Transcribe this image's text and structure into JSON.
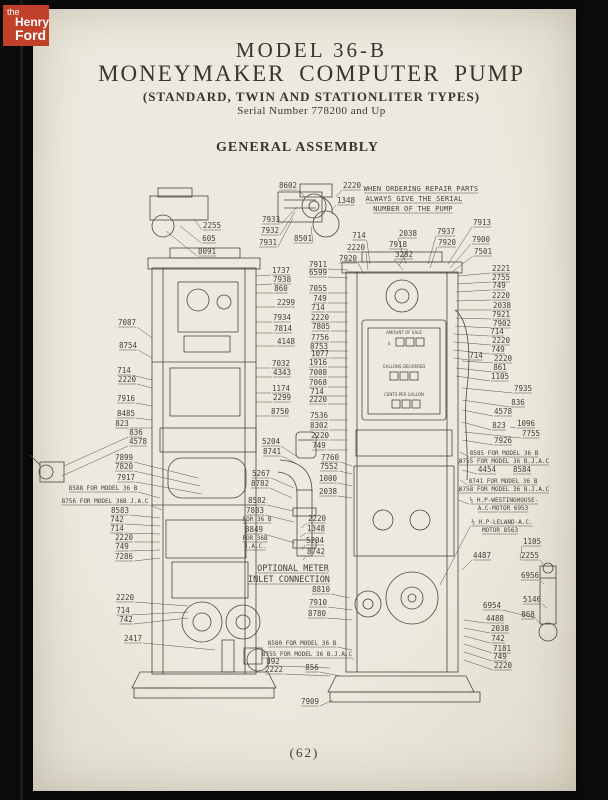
{
  "logo": {
    "the": "the",
    "henry": "Henry",
    "ford": "Ford"
  },
  "header": {
    "title_line1": "MODEL 36-B",
    "title_line2": "MONEYMAKER COMPUTER PUMP",
    "subtitle": "(STANDARD, TWIN AND STATIONLITER TYPES)",
    "serial": "Serial Number 778200 and Up",
    "section": "GENERAL ASSEMBLY"
  },
  "footer": {
    "page_number": "(62)"
  },
  "colors": {
    "page": "#e8e5d9",
    "ink": "#38352c",
    "line": "#4b473c",
    "logo_red": "#c0402a",
    "backdrop": "#0b0b0b"
  },
  "diagram": {
    "ordering_note": "WHEN ORDERING REPAIR PARTS ALWAYS GIVE THE SERIAL NUMBER OF THE PUMP",
    "face_lines": [
      [
        "AMOUNT OF SALE",
        404,
        334
      ],
      [
        "$",
        389,
        345
      ],
      [
        "GALLONS DELIVERED",
        404,
        368
      ],
      [
        "CENTS PER GALLON",
        404,
        396
      ]
    ],
    "labels": [
      [
        "WHEN ORDERING REPAIR PARTS",
        421,
        191,
        null,
        null,
        2
      ],
      [
        "ALWAYS GIVE THE SERIAL",
        414,
        201,
        null,
        null,
        2
      ],
      [
        "NUMBER OF THE PUMP",
        413,
        211,
        null,
        null,
        2
      ],
      [
        "8602",
        288,
        188,
        305,
        197
      ],
      [
        "2220",
        352,
        188,
        336,
        197
      ],
      [
        "1348",
        346,
        203,
        331,
        211
      ],
      [
        "2255",
        212,
        228,
        194,
        219
      ],
      [
        "605",
        209,
        241,
        180,
        226
      ],
      [
        "8091",
        207,
        254,
        166,
        231
      ],
      [
        "7933",
        271,
        222,
        297,
        207
      ],
      [
        "7932",
        270,
        233,
        295,
        212
      ],
      [
        "7931",
        268,
        245,
        293,
        218
      ],
      [
        "8501",
        303,
        241,
        311,
        227
      ],
      [
        "714",
        359,
        238,
        370,
        264
      ],
      [
        "2220",
        356,
        250,
        368,
        270
      ],
      [
        "7920",
        348,
        261,
        364,
        274
      ],
      [
        "2038",
        408,
        236,
        406,
        264
      ],
      [
        "7918",
        398,
        247,
        399,
        266
      ],
      [
        "3282",
        404,
        257,
        403,
        270
      ],
      [
        "7937",
        446,
        234,
        428,
        264
      ],
      [
        "7920",
        447,
        245,
        430,
        268
      ],
      [
        "7913",
        482,
        225,
        448,
        264
      ],
      [
        "7900",
        481,
        242,
        450,
        268
      ],
      [
        "7501",
        483,
        254,
        452,
        272
      ],
      [
        "2221",
        501,
        271,
        458,
        276
      ],
      [
        "2755",
        501,
        280,
        457,
        284
      ],
      [
        "749",
        499,
        288,
        456,
        292
      ],
      [
        "2220",
        501,
        298,
        456,
        301
      ],
      [
        "2038",
        502,
        308,
        456,
        310
      ],
      [
        "7921",
        501,
        317,
        456,
        318
      ],
      [
        "7902",
        502,
        326,
        455,
        326
      ],
      [
        "714",
        497,
        334,
        454,
        334
      ],
      [
        "2220",
        501,
        343,
        454,
        342
      ],
      [
        "749",
        498,
        352,
        453,
        350
      ],
      [
        "714",
        476,
        358,
        454,
        358
      ],
      [
        "2220",
        503,
        361,
        462,
        361
      ],
      [
        "861",
        500,
        370,
        456,
        368
      ],
      [
        "1105",
        500,
        379,
        456,
        376
      ],
      [
        "7935",
        523,
        391,
        462,
        388
      ],
      [
        "836",
        518,
        405,
        462,
        400
      ],
      [
        "4578",
        503,
        414,
        462,
        410
      ],
      [
        "823",
        499,
        428,
        462,
        422
      ],
      [
        "1096",
        526,
        426,
        510,
        427
      ],
      [
        "7755",
        531,
        436,
        464,
        432
      ],
      [
        "7926",
        503,
        443,
        462,
        440
      ],
      [
        "8585 FOR MODEL 36 B",
        504,
        455,
        460,
        452,
        1
      ],
      [
        "8755 FOR MODEL 36 B.J.A.C",
        504,
        463,
        460,
        460,
        1
      ],
      [
        "4454",
        487,
        472,
        462,
        470
      ],
      [
        "8584",
        522,
        472,
        null,
        null
      ],
      [
        "8741 FOR MODEL 36 B",
        503,
        483,
        460,
        480,
        1
      ],
      [
        "8758 FOR MODEL 36 B.J.A.C",
        504,
        491,
        460,
        488,
        1
      ],
      [
        "⅕ H.P-WESTINGHOUSE-",
        504,
        502,
        458,
        500,
        1
      ],
      [
        "A.C-MOTOR 6953",
        503,
        510,
        null,
        null,
        1
      ],
      [
        "⅕ H.P-LELAND-A.C.",
        502,
        524,
        440,
        585,
        1
      ],
      [
        "MOTOR 8563",
        500,
        532,
        null,
        null,
        1
      ],
      [
        "1105",
        532,
        544,
        520,
        560
      ],
      [
        "4487",
        482,
        558,
        462,
        570
      ],
      [
        "2255",
        530,
        558,
        545,
        566
      ],
      [
        "6956",
        530,
        578,
        544,
        584
      ],
      [
        "5146",
        532,
        602,
        547,
        608
      ],
      [
        "6954",
        492,
        608,
        536,
        618
      ],
      [
        "868",
        528,
        617,
        543,
        626
      ],
      [
        "4488",
        495,
        621,
        464,
        620
      ],
      [
        "2038",
        500,
        631,
        464,
        628
      ],
      [
        "742",
        498,
        641,
        464,
        636
      ],
      [
        "7181",
        502,
        651,
        464,
        644
      ],
      [
        "749",
        500,
        659,
        464,
        652
      ],
      [
        "2220",
        503,
        668,
        464,
        660
      ],
      [
        "7087",
        127,
        325,
        152,
        338
      ],
      [
        "8754",
        128,
        348,
        152,
        358
      ],
      [
        "714",
        124,
        373,
        152,
        380
      ],
      [
        "2220",
        127,
        382,
        152,
        388
      ],
      [
        "7916",
        126,
        401,
        152,
        406
      ],
      [
        "8485",
        126,
        416,
        152,
        420
      ],
      [
        "823",
        122,
        426,
        152,
        428
      ],
      [
        "836",
        136,
        435,
        64,
        466
      ],
      [
        "4578",
        138,
        444,
        62,
        476
      ],
      [
        "7899",
        124,
        460,
        198,
        478
      ],
      [
        "7820",
        124,
        469,
        200,
        486
      ],
      [
        "7917",
        126,
        480,
        202,
        494
      ],
      [
        "8588 FOR MODEL 36 B",
        103,
        490,
        160,
        498,
        1
      ],
      [
        "8756 FOR MODEL 36B J.A.C",
        105,
        503,
        162,
        510,
        1
      ],
      [
        "8583",
        120,
        513,
        160,
        518
      ],
      [
        "742",
        117,
        522,
        160,
        526
      ],
      [
        "714",
        117,
        531,
        160,
        534
      ],
      [
        "2220",
        124,
        540,
        160,
        542
      ],
      [
        "749",
        122,
        549,
        160,
        550
      ],
      [
        "7286",
        124,
        559,
        160,
        558
      ],
      [
        "2220",
        125,
        600,
        188,
        606
      ],
      [
        "714",
        123,
        613,
        188,
        612
      ],
      [
        "742",
        126,
        622,
        188,
        618
      ],
      [
        "2417",
        133,
        641,
        215,
        650
      ],
      [
        "1737",
        281,
        273,
        256,
        276
      ],
      [
        "7938",
        282,
        282,
        256,
        285
      ],
      [
        "860",
        281,
        291,
        256,
        293
      ],
      [
        "2299",
        286,
        305,
        256,
        307
      ],
      [
        "7934",
        282,
        320,
        256,
        322
      ],
      [
        "7814",
        283,
        331,
        256,
        333
      ],
      [
        "4148",
        286,
        344,
        256,
        346
      ],
      [
        "7032",
        281,
        366,
        256,
        368
      ],
      [
        "4343",
        282,
        375,
        256,
        377
      ],
      [
        "1174",
        281,
        391,
        256,
        393
      ],
      [
        "2299",
        282,
        400,
        256,
        402
      ],
      [
        "8750",
        280,
        414,
        256,
        416
      ],
      [
        "5204",
        271,
        444,
        296,
        456
      ],
      [
        "8741",
        272,
        454,
        297,
        464
      ],
      [
        "5267",
        261,
        476,
        294,
        488
      ],
      [
        "8782",
        260,
        486,
        292,
        498
      ],
      [
        "8582",
        257,
        503,
        293,
        511
      ],
      [
        "7883",
        255,
        513,
        294,
        522
      ],
      [
        "FOR 36 B",
        257,
        521,
        null,
        null,
        1
      ],
      [
        "8849",
        254,
        532,
        295,
        543
      ],
      [
        "FOR 36B",
        255,
        540,
        null,
        null,
        1
      ],
      [
        "J.A.C.",
        255,
        548,
        null,
        null,
        1
      ],
      [
        "7911",
        318,
        267,
        348,
        270
      ],
      [
        "6599",
        318,
        275,
        348,
        278
      ],
      [
        "7055",
        318,
        291,
        348,
        293
      ],
      [
        "749",
        320,
        301,
        348,
        303
      ],
      [
        "714",
        318,
        310,
        348,
        312
      ],
      [
        "2220",
        320,
        320,
        348,
        322
      ],
      [
        "7805",
        321,
        329,
        348,
        331
      ],
      [
        "7756",
        320,
        340,
        348,
        342
      ],
      [
        "8753",
        319,
        349,
        348,
        351
      ],
      [
        "1077",
        320,
        356,
        348,
        358
      ],
      [
        "1916",
        318,
        365,
        348,
        367
      ],
      [
        "7008",
        318,
        375,
        348,
        377
      ],
      [
        "7068",
        318,
        385,
        348,
        387
      ],
      [
        "714",
        317,
        394,
        348,
        396
      ],
      [
        "2220",
        318,
        402,
        348,
        404
      ],
      [
        "7536",
        319,
        418,
        348,
        420
      ],
      [
        "8302",
        319,
        428,
        348,
        430
      ],
      [
        "2220",
        320,
        438,
        348,
        440
      ],
      [
        "749",
        319,
        448,
        348,
        450
      ],
      [
        "7760",
        330,
        460,
        352,
        466
      ],
      [
        "7552",
        329,
        469,
        352,
        474
      ],
      [
        "1000",
        328,
        481,
        352,
        486
      ],
      [
        "2038",
        328,
        494,
        352,
        498
      ],
      [
        "2220",
        317,
        521,
        301,
        528
      ],
      [
        "1348",
        316,
        531,
        300,
        537
      ],
      [
        "5204",
        315,
        543,
        302,
        550
      ],
      [
        "8742",
        316,
        554,
        303,
        560
      ],
      [
        "OPTIONAL METER",
        293,
        571,
        null,
        null,
        3
      ],
      [
        "INLET CONNECTION",
        289,
        582,
        null,
        null,
        3
      ],
      [
        "8810",
        321,
        592,
        350,
        598
      ],
      [
        "7910",
        318,
        605,
        352,
        610
      ],
      [
        "8780",
        317,
        616,
        352,
        620
      ],
      [
        "8580 FOR MODEL 36 B",
        302,
        645,
        352,
        650,
        1
      ],
      [
        "8755 FOR MODEL 36 B.J.A.C",
        307,
        656,
        353,
        660,
        1
      ],
      [
        "892",
        273,
        664,
        330,
        668
      ],
      [
        "2222",
        274,
        672,
        330,
        676
      ],
      [
        "856",
        312,
        670,
        340,
        676
      ],
      [
        "7909",
        310,
        704,
        333,
        700
      ]
    ]
  }
}
